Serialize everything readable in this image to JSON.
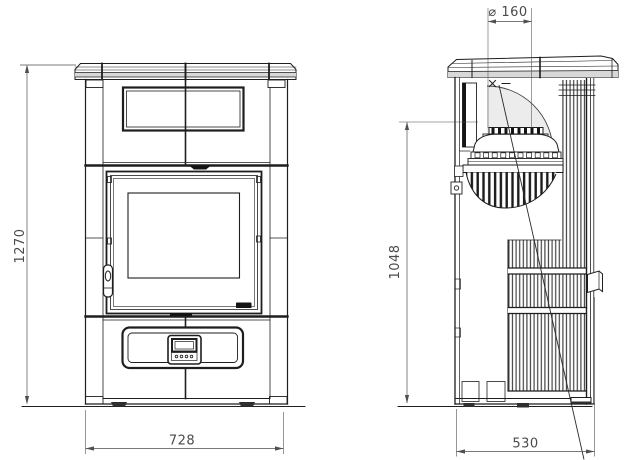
{
  "drawing": {
    "dimensions": {
      "overall_height": "1270",
      "front_width": "728",
      "side_depth": "530",
      "flue_center_height": "1048",
      "flue_diameter": "⌀ 160"
    },
    "colors": {
      "line": "#1e1e1e",
      "dim_line": "#4f4f4f",
      "dim_text": "#4a4a4a",
      "plate_fill": "#f3f3f3",
      "plate_band": "#d8d8d8",
      "swivel_shade": "#ececec",
      "background": "#ffffff"
    }
  }
}
